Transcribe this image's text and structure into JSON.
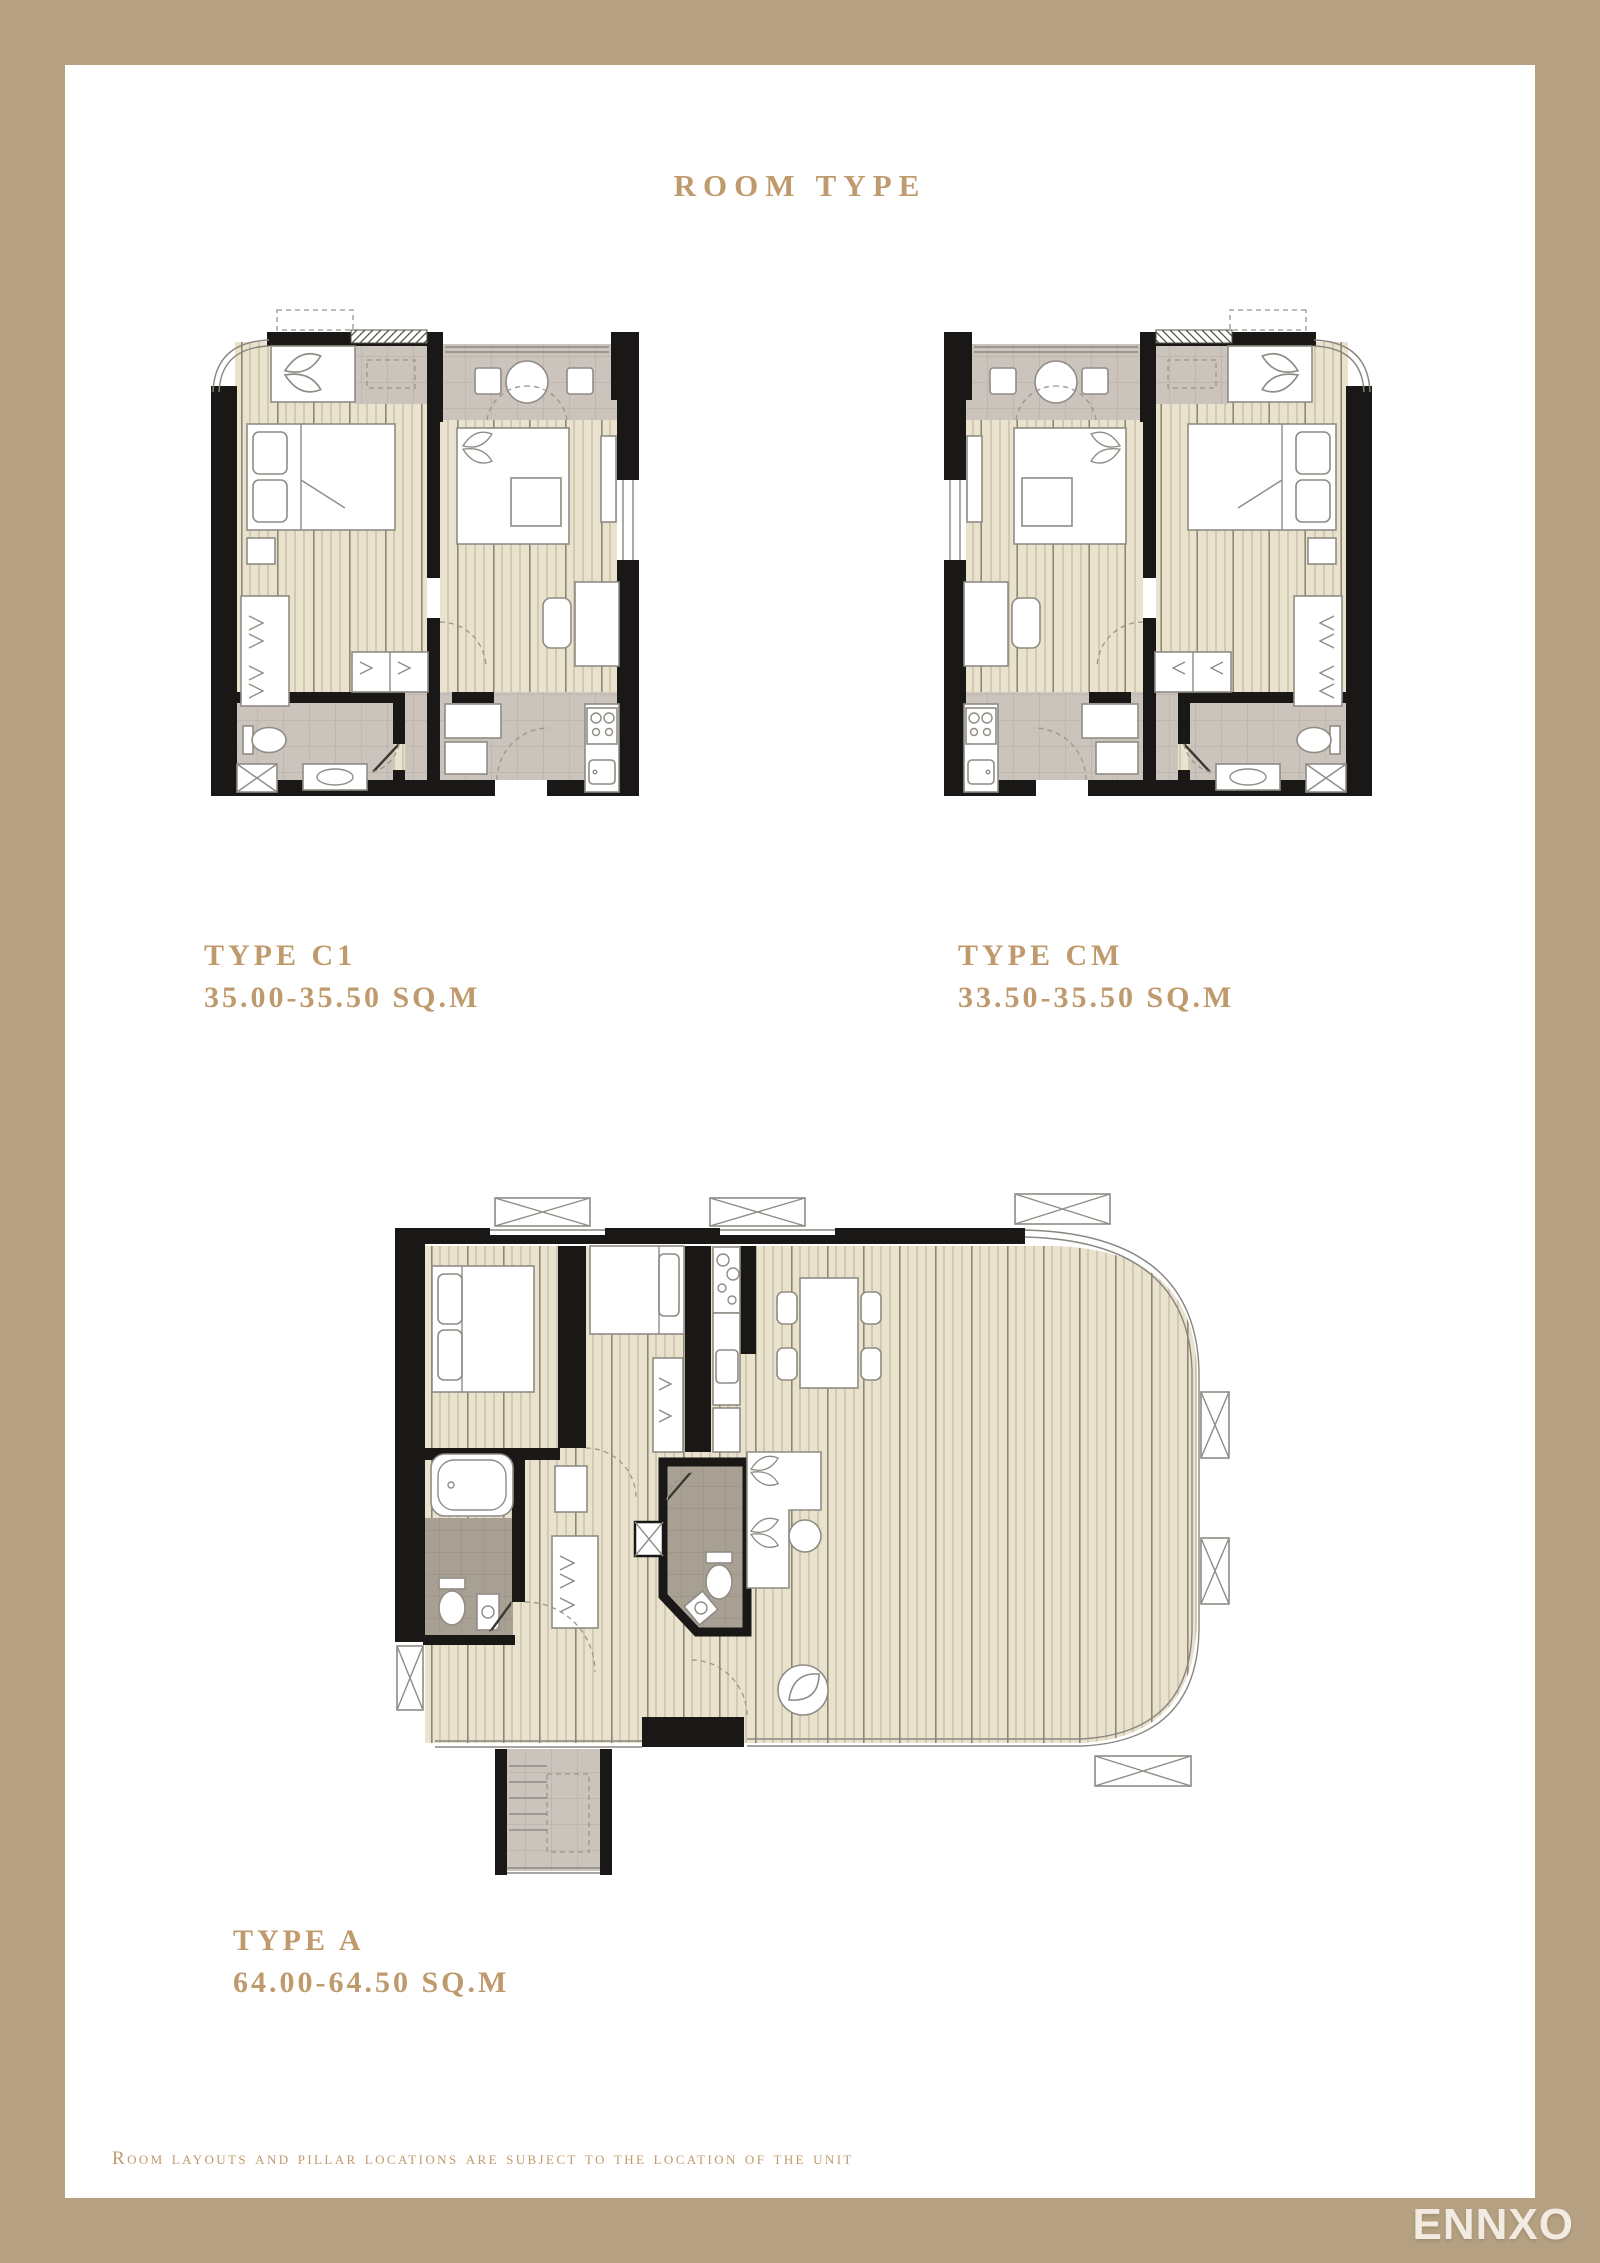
{
  "page": {
    "title": "ROOM TYPE",
    "footer_note": "Room layouts and pillar locations are subject to the location of the unit",
    "watermark": "ENNXO"
  },
  "plans": [
    {
      "id": "C1",
      "type_label": "TYPE C1",
      "area_label": "35.00-35.50 SQ.M"
    },
    {
      "id": "CM",
      "type_label": "TYPE CM",
      "area_label": "33.50-35.50 SQ.M"
    },
    {
      "id": "A",
      "type_label": "TYPE A",
      "area_label": "64.00-64.50 SQ.M"
    }
  ],
  "colors": {
    "frame": "#B5A081",
    "paper": "#FFFFFF",
    "accent": "#BF9A6C",
    "wall": "#1A1816",
    "wood": "#E9E2CC",
    "wood_line": "#B9B09B",
    "tile": "#CBC4BC",
    "tile_line": "#B2ABA2",
    "taupe": "#A9A094",
    "taupe_line": "#968E82",
    "furn_stroke": "#8F8C85",
    "glass": "#8A8781",
    "dash": "#9B958C",
    "watermark": "#F1EBE2"
  }
}
